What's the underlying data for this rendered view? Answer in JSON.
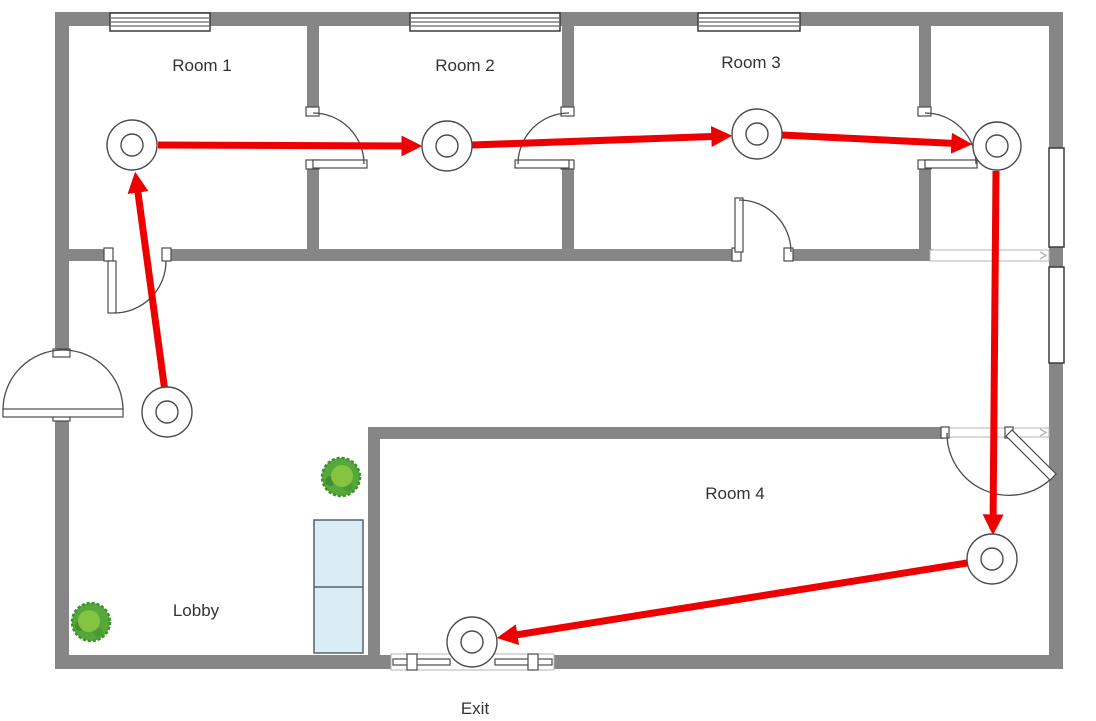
{
  "page": {
    "background": "#ffffff"
  },
  "floor_plan": {
    "kind": "evacuation-route-floor-plan",
    "labels": {
      "room1": "Room 1",
      "room2": "Room 2",
      "room3": "Room 3",
      "room4": "Room 4",
      "lobby": "Lobby",
      "exit": "Exit"
    },
    "route": {
      "color": "#ee0000",
      "node_symbol": "concentric-circle-marker",
      "node_count": 7,
      "stop_sequence": [
        "Lobby",
        "Room 1",
        "Room 2",
        "Room 3",
        "Hallway",
        "Room 4",
        "Exit"
      ]
    },
    "elements": {
      "windows_top_wall": 3,
      "windows_right_wall": 2,
      "single_doors": 5,
      "double_doors": 2,
      "sliding_exit_door": 1,
      "plants": 2,
      "furniture": "cabinet"
    },
    "colors": {
      "wall": "#868686",
      "symbol_line": "#4b4b4b",
      "route_red": "#ee0000",
      "furniture_fill": "#daedf6",
      "furniture_stroke": "#55626e",
      "plant_mid": "#57a83b",
      "plant_dark": "#3f8f2e",
      "plant_light": "#85c441",
      "label_text": "#333333"
    }
  }
}
